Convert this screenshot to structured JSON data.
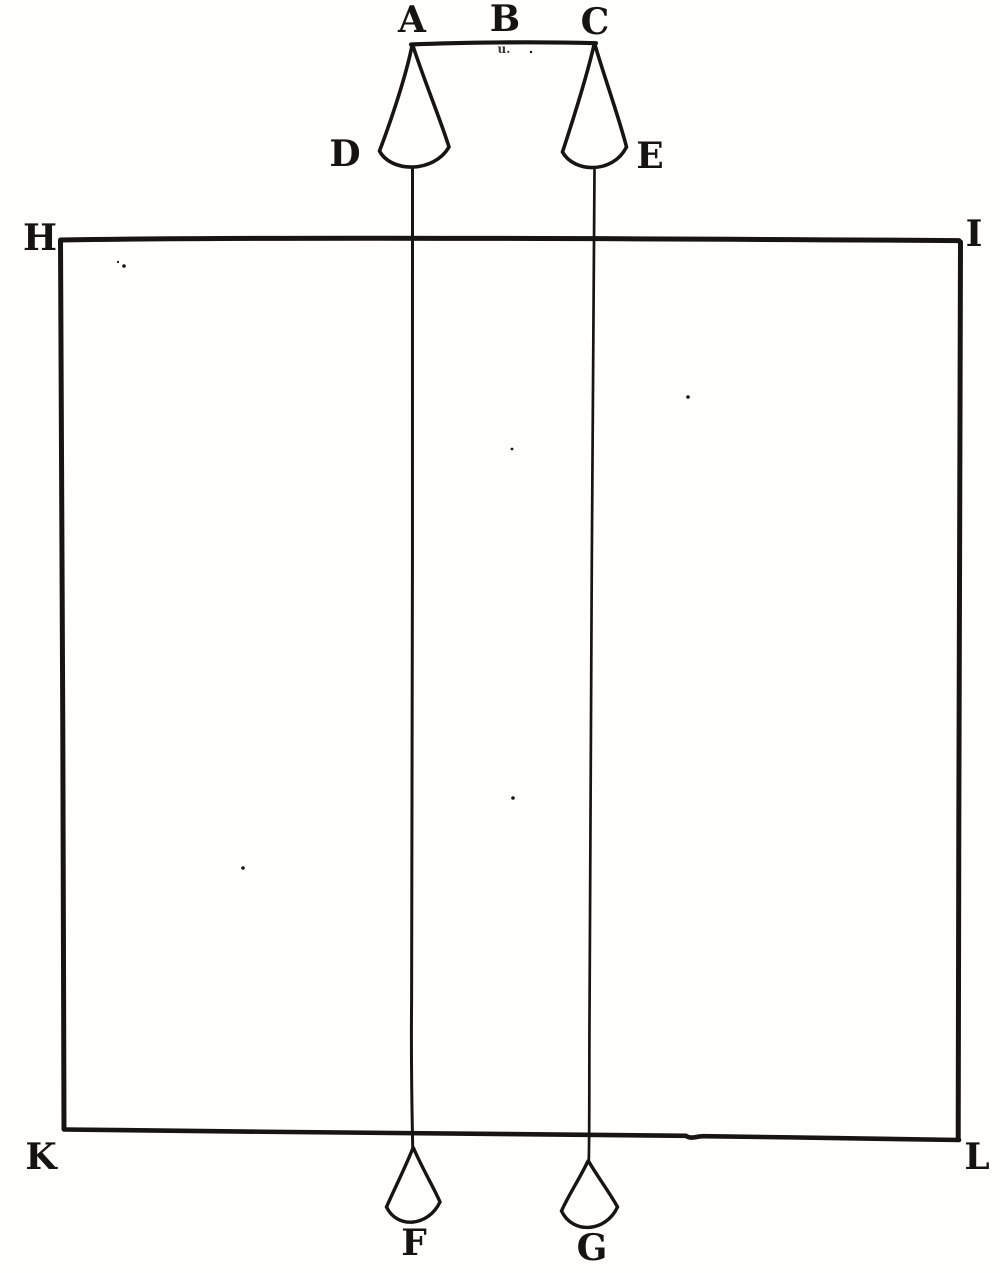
{
  "figure": {
    "description": "Scanned line engraving: two suspended plumb cones D and E hanging from bar A B C, plumb lines passing over rectangular screen H I K L, ending in cones F and G",
    "ink_color": "#171513",
    "paper_color": "#fffefc",
    "print_artifact": "u.",
    "labels": {
      "A": "A",
      "B": "B",
      "C": "C",
      "D": "D",
      "E": "E",
      "F": "F",
      "G": "G",
      "H": "H",
      "I": "I",
      "K": "K",
      "L": "L"
    }
  }
}
